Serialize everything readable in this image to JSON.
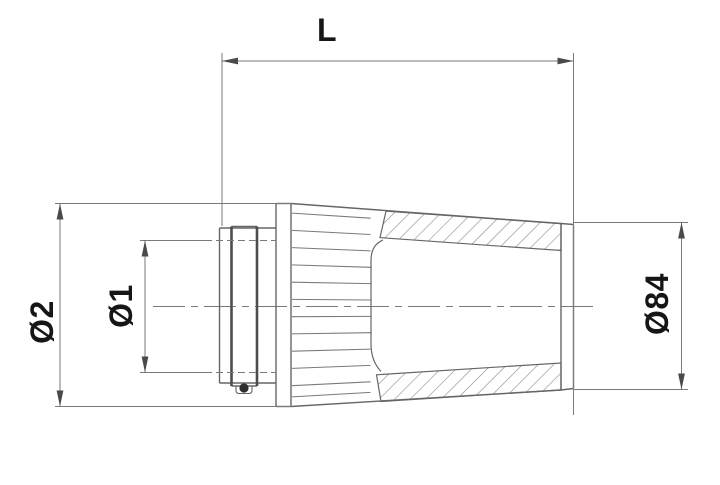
{
  "drawing": {
    "labels": {
      "length": "L",
      "diameter_outer": "Ø2",
      "diameter_inner": "Ø1",
      "diameter_cap": "Ø84"
    },
    "colors": {
      "object_line": "#666666",
      "thin_line": "#7a7a7a",
      "section_line": "#4d4d4d",
      "hatch_line": "#8a8a8a",
      "arrow": "#4a4a4a",
      "text": "#161616",
      "bead": "#2f2f2f",
      "background": "#ffffff"
    }
  }
}
